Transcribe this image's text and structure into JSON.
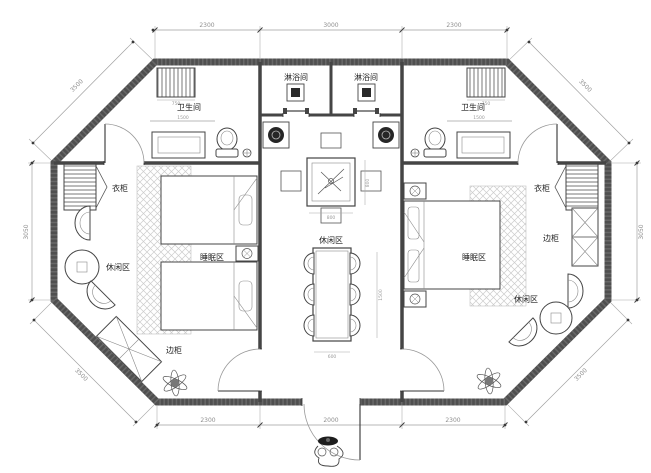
{
  "plan": {
    "rooms": {
      "shower": "淋浴间",
      "bathroom": "卫生间",
      "wardrobe": "衣柜",
      "sleeping_area": "睡眠区",
      "leisure_area": "休闲区",
      "side_cabinet": "边柜"
    },
    "dimensions": {
      "top_left": "2300",
      "top_middle": "3000",
      "top_right": "2300",
      "bottom_left": "2300",
      "bottom_middle": "2000",
      "bottom_right": "2300",
      "side_left": "3050",
      "side_right": "3050",
      "diagonal": "3500",
      "small": {
        "towel_rack": "750",
        "vanity": "1500",
        "tea_table": "800",
        "dining_width": "600",
        "dining_length": "1500"
      }
    },
    "colors": {
      "wall": "#4f4f4f",
      "line": "#3a3a3a",
      "dim_text": "#8f8f8f",
      "carpet_hatch": "#cccccc",
      "label_text": "#1f1f1f"
    }
  }
}
